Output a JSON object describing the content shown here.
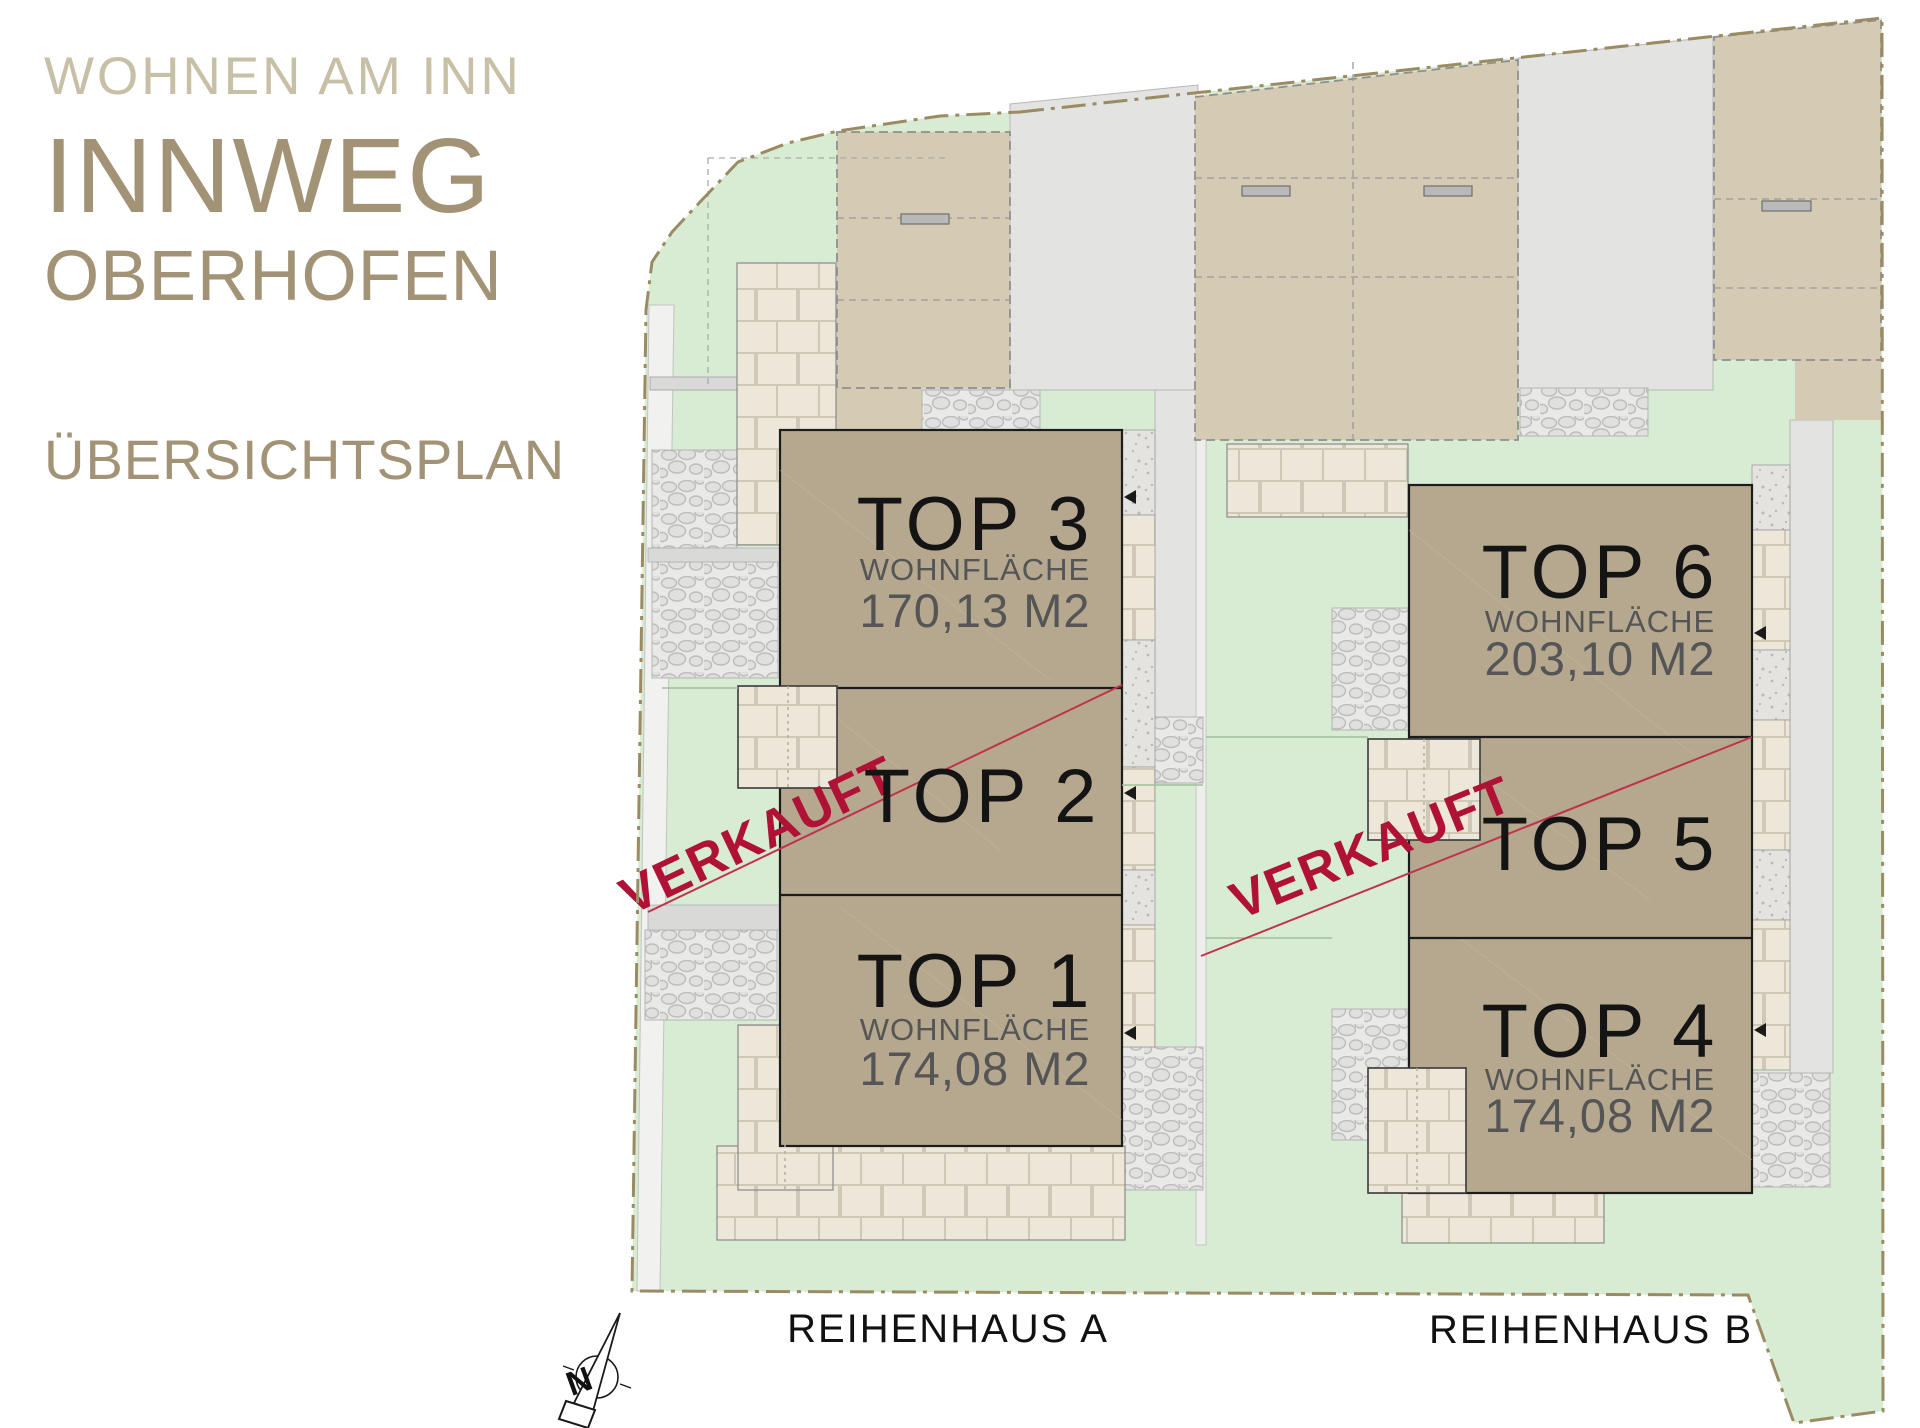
{
  "header": {
    "project": "WOHNEN AM INN",
    "name": "INNWEG",
    "location": "OBERHOFEN",
    "subtitle": "ÜBERSICHTSPLAN"
  },
  "buildings": {
    "a": {
      "label": "REIHENHAUS A",
      "units": [
        {
          "id": "top3",
          "name": "TOP 3",
          "area_label": "WOHNFLÄCHE",
          "area": "170,13 M2",
          "sold": false
        },
        {
          "id": "top2",
          "name": "TOP 2",
          "sold": true
        },
        {
          "id": "top1",
          "name": "TOP 1",
          "area_label": "WOHNFLÄCHE",
          "area": "174,08 M2",
          "sold": false
        }
      ]
    },
    "b": {
      "label": "REIHENHAUS B",
      "units": [
        {
          "id": "top6",
          "name": "TOP 6",
          "area_label": "WOHNFLÄCHE",
          "area": "203,10 M2",
          "sold": false
        },
        {
          "id": "top5",
          "name": "TOP 5",
          "sold": true
        },
        {
          "id": "top4",
          "name": "TOP 4",
          "area_label": "WOHNFLÄCHE",
          "area": "174,08 M2",
          "sold": false
        }
      ]
    }
  },
  "sold_stamp": "VERKAUFT",
  "compass": {
    "label": "N"
  },
  "colors": {
    "title_light": "#c7bfa6",
    "title_dark": "#a39376",
    "lawn": "#d8ecd4",
    "building": "#b5a88e",
    "garage": "#d5cbb4",
    "road": "#e3e3e1",
    "tiles": "#ece7d9",
    "gravel": "#e9e9e7",
    "boundary": "#9b8b63",
    "sold_red": "#b01236",
    "sold_line": "#c0334d",
    "text_dark": "#141414",
    "text_gray": "#555555"
  }
}
